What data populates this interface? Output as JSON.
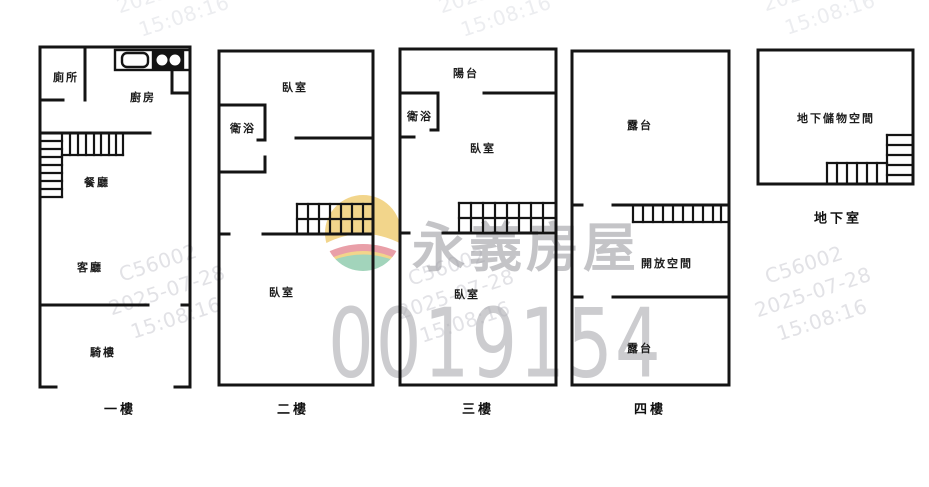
{
  "document": {
    "type": "real-estate-floorplan",
    "floor_count": 5
  },
  "floors": {
    "f1": {
      "caption": "一樓",
      "rooms": {
        "toilet": "廁所",
        "kitchen": "廚房",
        "dining": "餐廳",
        "living": "客廳",
        "arcade": "騎樓"
      }
    },
    "f2": {
      "caption": "二樓",
      "rooms": {
        "bedroom_top": "臥室",
        "bath": "衛浴",
        "bedroom_bottom": "臥室"
      }
    },
    "f3": {
      "caption": "三樓",
      "rooms": {
        "balcony": "陽台",
        "bath": "衛浴",
        "bedroom_mid": "臥室",
        "bedroom_bottom": "臥室"
      }
    },
    "f4": {
      "caption": "四樓",
      "rooms": {
        "terrace_top": "露台",
        "open_space": "開放空間",
        "terrace_bottom": "露台"
      }
    },
    "basement": {
      "caption": "地下室",
      "rooms": {
        "storage": "地下儲物空間"
      }
    }
  },
  "watermarks": {
    "brand_name": "永義房屋",
    "serial_number": "0019154",
    "stamp": {
      "agent_code": "C56002",
      "date": "2025-07-28",
      "time": "15:08:16"
    },
    "colors": {
      "logo_yellow": "#f2d385",
      "logo_pink": "#e89aa4",
      "logo_green": "#9ed2b8",
      "stamp_grey_top": "#ecedf0",
      "stamp_grey_mid": "#e2e2e6",
      "brand_grey": "#b8b8bb",
      "serial_grey": "#c9c9cc",
      "wall_black": "#141414"
    }
  }
}
